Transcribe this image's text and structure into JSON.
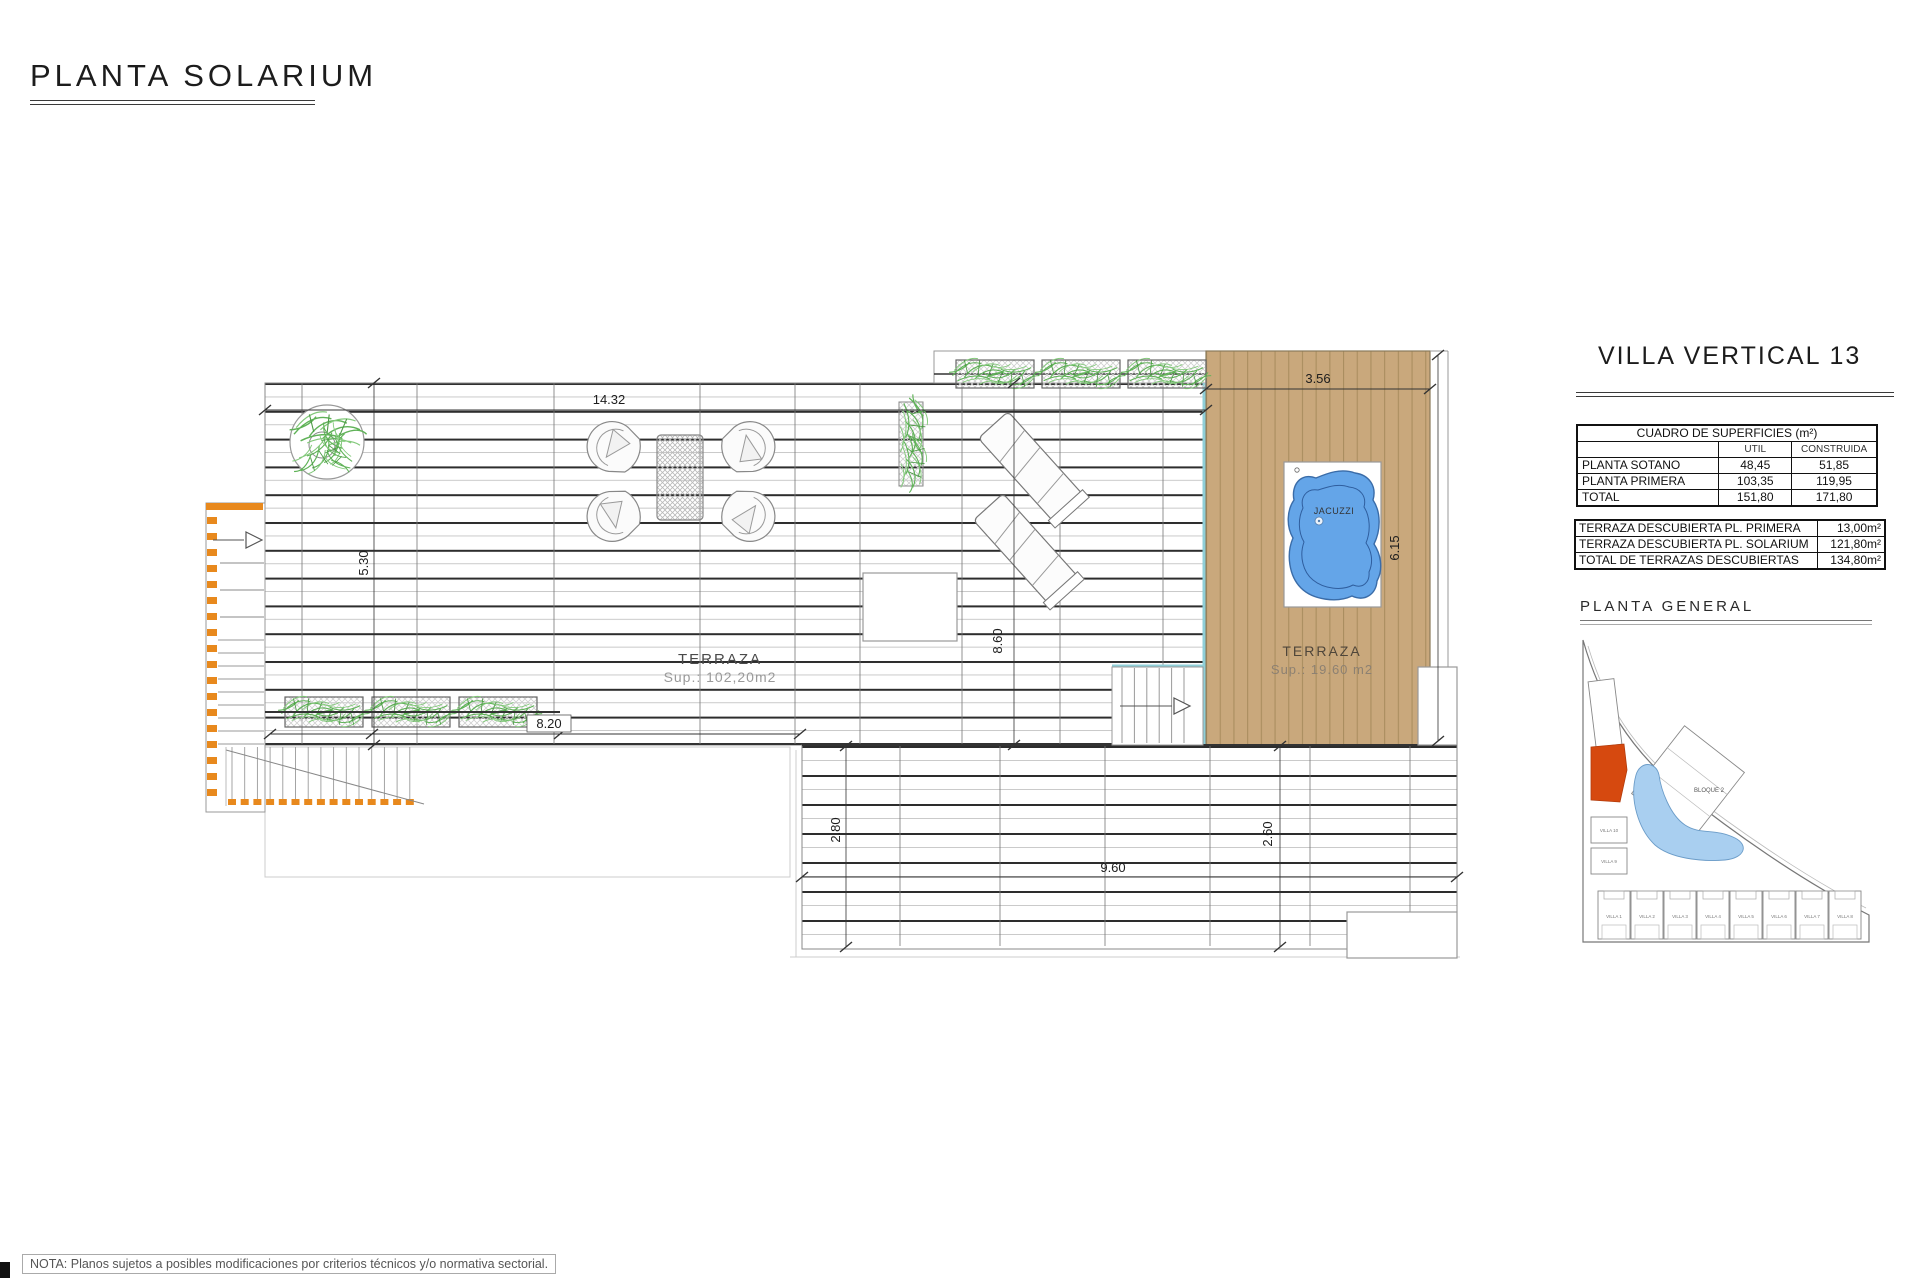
{
  "page": {
    "title": "PLANTA SOLARIUM",
    "note": "NOTA: Planos sujetos a posibles modificaciones por criterios técnicos y/o normativa sectorial."
  },
  "plan": {
    "terrace_main": {
      "label": "TERRAZA",
      "area": "Sup.: 102,20m2"
    },
    "terrace_deck": {
      "label": "TERRAZA",
      "area": "Sup.: 19.60  m2"
    },
    "jacuzzi_label": "JACUZZI",
    "dims": {
      "width_main": "14.32",
      "width_deck": "3.56",
      "height_left": "5.30",
      "height_mid": "8.60",
      "height_deck": "6.15",
      "width_planters": "8.20",
      "height_lower_left": "2.80",
      "width_lower": "9.60",
      "height_lower_right": "2.60"
    },
    "colors": {
      "deck_wood": "#C9A87C",
      "deck_plank_line": "#AA8E5F",
      "water": "#64A5E8",
      "pool_edge_cyan": "#8FCFD8",
      "stairs_accent_orange": "#E8891D",
      "vegetation_green": "#5FB257",
      "site_highlight_red": "#D6490F"
    }
  },
  "side_panel": {
    "title": "VILLA VERTICAL 13",
    "surfaces_table": {
      "title": "CUADRO DE SUPERFICIES (m²)",
      "col_util": "UTIL",
      "col_construida": "CONSTRUIDA",
      "rows": [
        {
          "label": "PLANTA SOTANO",
          "util": "48,45",
          "construida": "51,85"
        },
        {
          "label": "PLANTA PRIMERA",
          "util": "103,35",
          "construida": "119,95"
        },
        {
          "label": "TOTAL",
          "util": "151,80",
          "construida": "171,80"
        }
      ]
    },
    "terraces_table": {
      "rows": [
        {
          "label": "TERRAZA DESCUBIERTA PL. PRIMERA",
          "value": "13,00m²"
        },
        {
          "label": "TERRAZA DESCUBIERTA PL. SOLARIUM",
          "value": "121,80m²"
        },
        {
          "label": "TOTAL DE TERRAZAS DESCUBIERTAS",
          "value": "134,80m²"
        }
      ]
    },
    "site_plan": {
      "title": "PLANTA GENERAL",
      "bloque2_label": "BLOQUE 2",
      "villas_left": [
        "VILLA 10",
        "VILLA 9"
      ],
      "villas_bottom": [
        "VILLA 1",
        "VILLA 2",
        "VILLA 3",
        "VILLA 4",
        "VILLA 5",
        "VILLA 6",
        "VILLA 7",
        "VILLA 8"
      ]
    }
  }
}
